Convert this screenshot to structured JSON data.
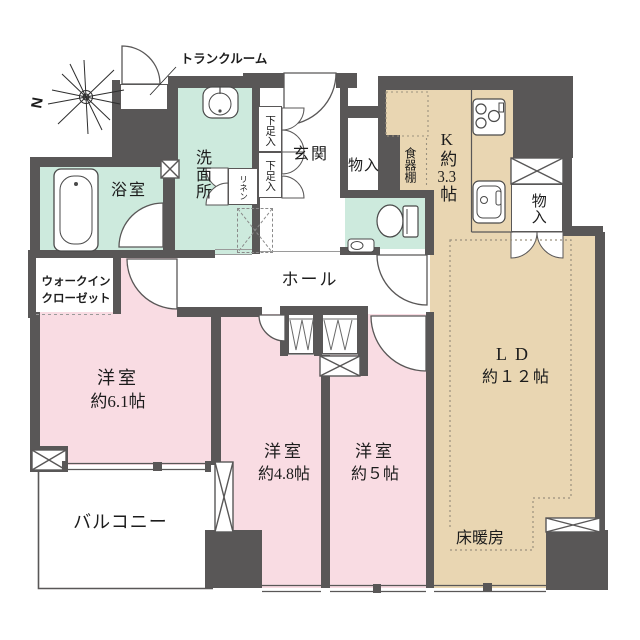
{
  "title": "3LDK間取り図",
  "compass": {
    "north_label": "N"
  },
  "colors": {
    "wall": "#595757",
    "wet_area": "#cdeadd",
    "bedroom": "#f9dce3",
    "living": "#e9d6b2",
    "line": "#595757"
  },
  "rooms": {
    "trunk": "トランクルーム",
    "washroom": "洗面所",
    "bathroom": "浴室",
    "wic_line1": "ウォークイン",
    "wic_line2": "クローゼット",
    "genkan": "玄関",
    "shoe1": "下足入",
    "shoe2": "下足入",
    "linen": "リネン",
    "storage_top": "物入",
    "storage_right": "物入",
    "cupboard": "食器棚",
    "kitchen_prefix": "K約",
    "kitchen_num": "3.3",
    "kitchen_suffix": "帖",
    "hall": "ホール",
    "ld_line1": "LD",
    "ld_line2": "約１２帖",
    "bed1_line1": "洋室",
    "bed1_line2": "約6.1帖",
    "bed2_line1": "洋室",
    "bed2_line2": "約4.8帖",
    "bed3_line1": "洋室",
    "bed3_line2": "約５帖",
    "balcony": "バルコニー",
    "floor_heating": "床暖房"
  }
}
